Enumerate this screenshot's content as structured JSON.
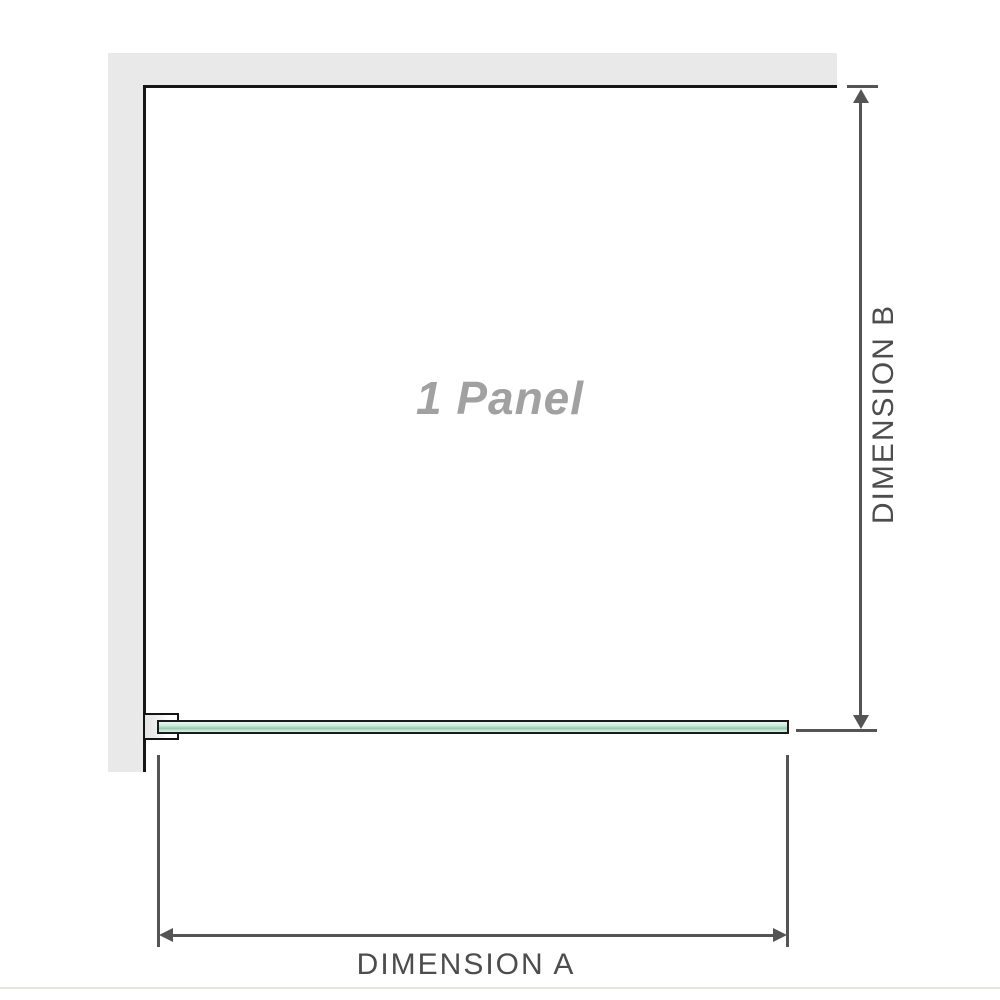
{
  "diagram": {
    "type": "shower-screen-floor-plan",
    "panel_label": "1 Panel",
    "dimension_a_label": "DIMENSION A",
    "dimension_b_label": "DIMENSION B"
  },
  "colors": {
    "wall_fill": "#e9e9e9",
    "wall_inner_edge": "#161616",
    "glass_light_green": "#d9efe3",
    "glass_dark_green": "#8cc8a8",
    "glass_border": "#1a1a1a",
    "dimension_line": "#545454",
    "dimension_label_text": "#4d4d4d",
    "panel_label_text": "#a1a1a1",
    "baseline_line": "#e8e5df",
    "background": "#ffffff"
  }
}
